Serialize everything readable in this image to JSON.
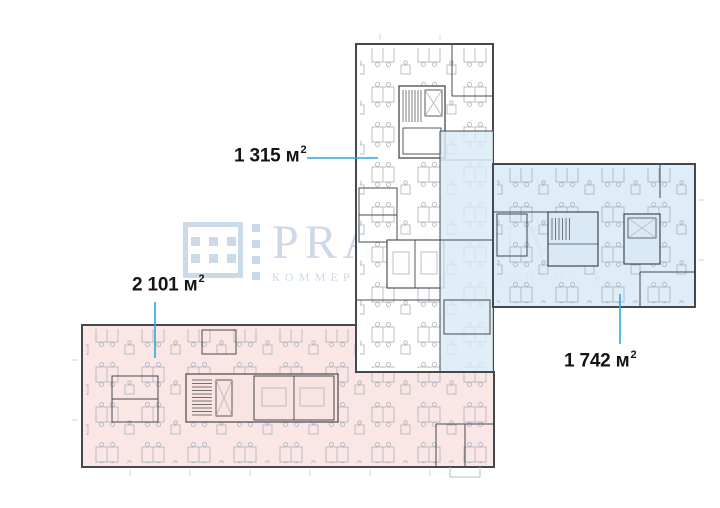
{
  "watermark": {
    "brand": "PRAEDIUM",
    "tagline": "КОММЕРЧЕСКАЯ НЕДВИЖИМОСТЬ"
  },
  "areas": {
    "top_wing": {
      "label": "1 315 м",
      "sup": "2"
    },
    "left_wing": {
      "label": "2 101 м",
      "sup": "2"
    },
    "right_wing": {
      "label": "1 742 м",
      "sup": "2"
    }
  },
  "colors": {
    "zone_blue": "#d9eaf6",
    "zone_pink": "#f9e4e2",
    "leader": "#29a9e2",
    "wall": "#45484d",
    "furniture": "#aab1b9",
    "watermark": "#ccd9e7"
  }
}
